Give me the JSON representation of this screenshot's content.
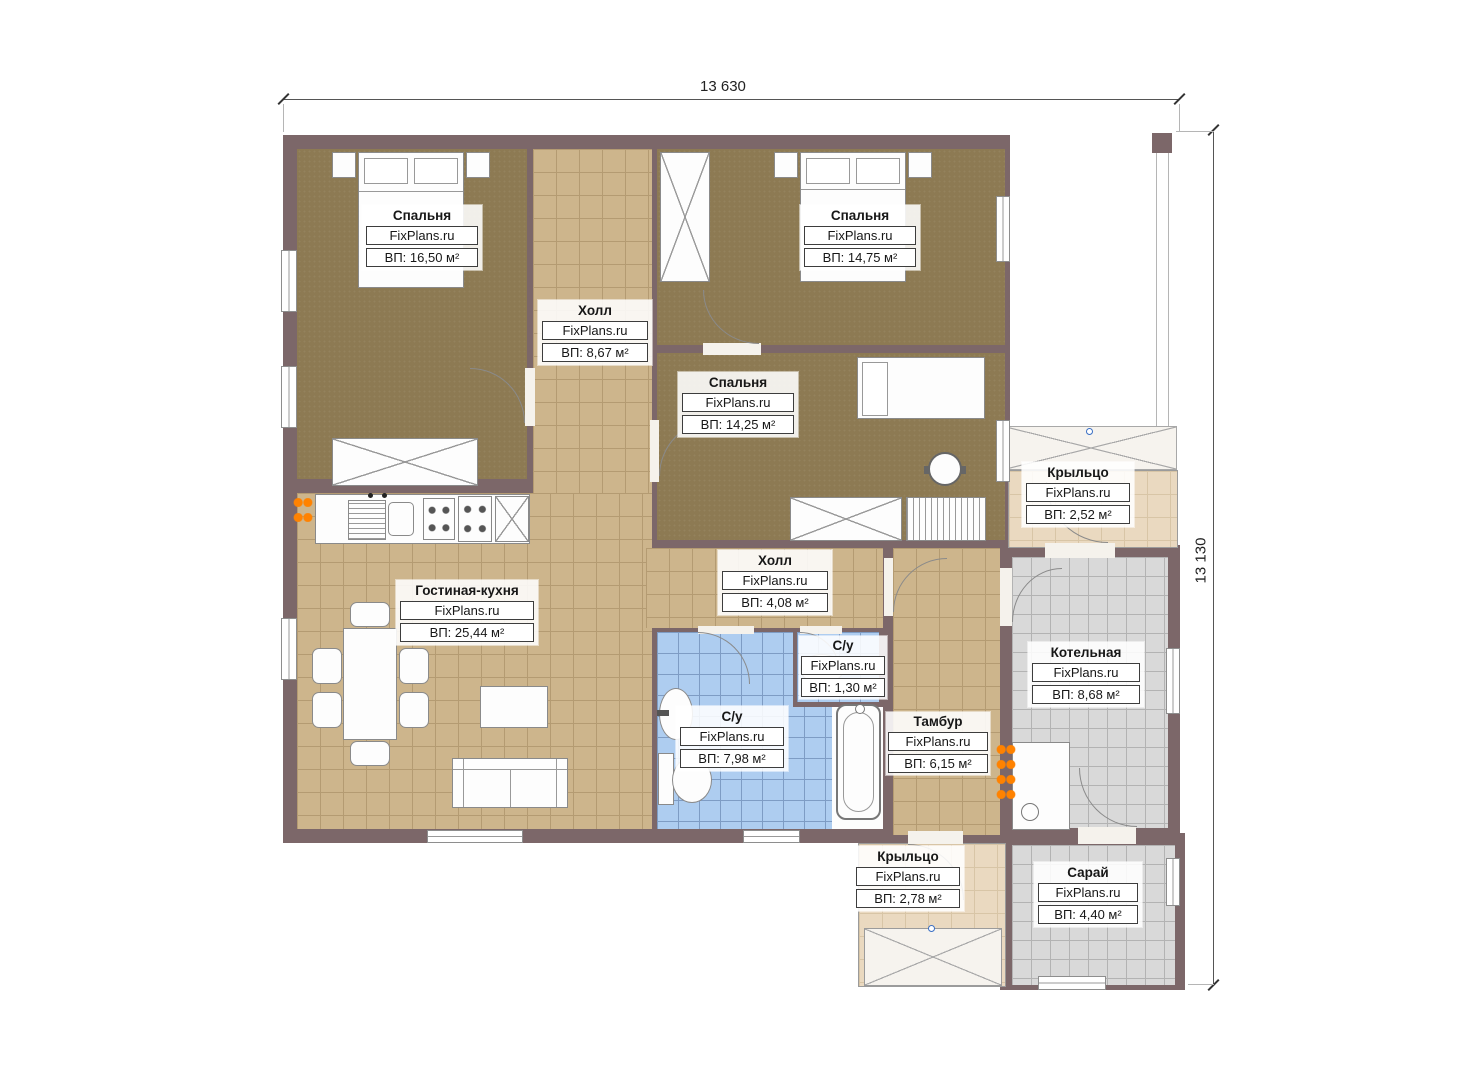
{
  "watermark": "FixPlans.ru",
  "dimensions": {
    "width_label": "13 630",
    "height_label": "13 130"
  },
  "rooms": [
    {
      "id": "bedroom-1",
      "name": "Спальня",
      "area": "ВП: 16,50 м²"
    },
    {
      "id": "hall-upper",
      "name": "Холл",
      "area": "ВП: 8,67 м²"
    },
    {
      "id": "bedroom-2",
      "name": "Спальня",
      "area": "ВП: 14,75 м²"
    },
    {
      "id": "bedroom-3",
      "name": "Спальня",
      "area": "ВП: 14,25 м²"
    },
    {
      "id": "porch-right",
      "name": "Крыльцо",
      "area": "ВП: 2,52 м²"
    },
    {
      "id": "living-kitchen",
      "name": "Гостиная-кухня",
      "area": "ВП: 25,44 м²"
    },
    {
      "id": "hall-lower",
      "name": "Холл",
      "area": "ВП: 4,08 м²"
    },
    {
      "id": "wc-small",
      "name": "С/у",
      "area": "ВП: 1,30 м²"
    },
    {
      "id": "wc-large",
      "name": "С/у",
      "area": "ВП: 7,98 м²"
    },
    {
      "id": "vestibule",
      "name": "Тамбур",
      "area": "ВП: 6,15 м²"
    },
    {
      "id": "boiler-room",
      "name": "Котельная",
      "area": "ВП: 8,68 м²"
    },
    {
      "id": "porch-bottom",
      "name": "Крыльцо",
      "area": "ВП: 2,78 м²"
    },
    {
      "id": "shed",
      "name": "Сарай",
      "area": "ВП: 4,40 м²"
    }
  ],
  "colors": {
    "wall": "#7c6769",
    "floor_tan": "#cdb58c",
    "floor_carpet": "#8d7a53",
    "floor_blue": "#aecdf0",
    "floor_gray": "#d9d9d9",
    "floor_porch": "#ead9c0",
    "radiator": "#ff8200"
  }
}
